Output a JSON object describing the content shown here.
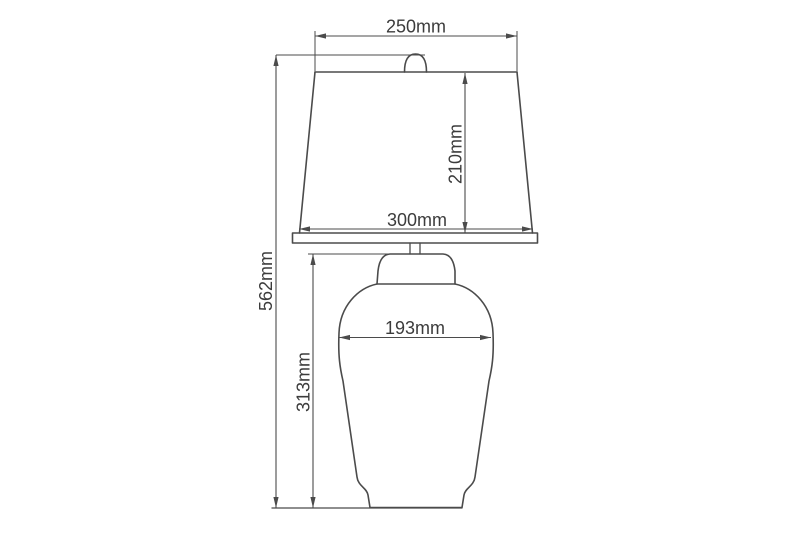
{
  "diagram": {
    "type": "technical-dimension-drawing",
    "subject": "table lamp with shade and vase body, front elevation",
    "unit": "mm",
    "colors": {
      "line": "#4b4b4b",
      "text": "#3c3c3c",
      "background": "#ffffff"
    },
    "dims": {
      "shade_top_width": "250mm",
      "shade_height": "210mm",
      "shade_bottom_width": "300mm",
      "total_height": "562mm",
      "body_width": "193mm",
      "body_height": "313mm"
    }
  }
}
